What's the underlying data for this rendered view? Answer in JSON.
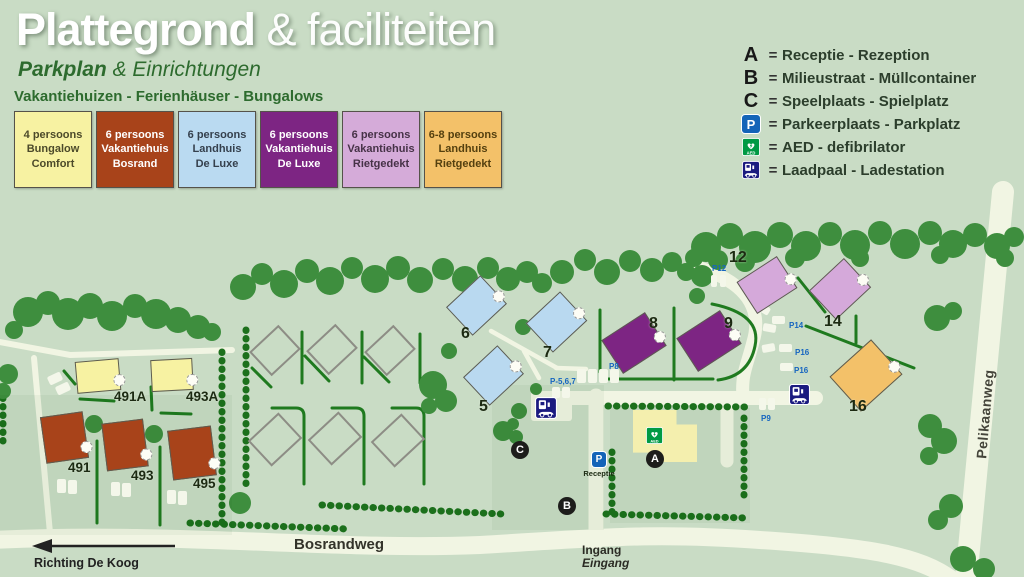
{
  "title": {
    "word1": "Plattegrond",
    "word2": "& faciliteiten",
    "sub1": "Parkplan",
    "sub2": "& Einrichtungen",
    "tagline": "Vakantiehuizen - Ferienhäuser - Bungalows"
  },
  "house_types": [
    {
      "id": "bungalow-comfort",
      "lines": [
        "4 persoons",
        "Bungalow",
        "Comfort"
      ],
      "bg": "#f7f2a2"
    },
    {
      "id": "vakantiehuis-bosrand",
      "lines": [
        "6 persoons",
        "Vakantiehuis",
        "Bosrand"
      ],
      "bg": "#a8431a"
    },
    {
      "id": "landhuis-de-luxe",
      "lines": [
        "6 persoons",
        "Landhuis",
        "De Luxe"
      ],
      "bg": "#badaf1"
    },
    {
      "id": "vakantiehuis-de-luxe",
      "lines": [
        "6 persoons",
        "Vakantiehuis",
        "De Luxe"
      ],
      "bg": "#7d2583"
    },
    {
      "id": "vakantiehuis-rietgedekt",
      "lines": [
        "6 persoons",
        "Vakantiehuis",
        "Rietgedekt"
      ],
      "bg": "#d5abd9"
    },
    {
      "id": "landhuis-rietgedekt",
      "lines": [
        "6-8 persoons",
        "Landhuis",
        "Rietgedekt"
      ],
      "bg": "#f3c169"
    }
  ],
  "facilities": [
    {
      "symbol": "A",
      "type": "letter",
      "label": "Receptie - Rezeption"
    },
    {
      "symbol": "B",
      "type": "letter",
      "label": "Milieustraat - Müllcontainer"
    },
    {
      "symbol": "C",
      "type": "letter",
      "label": "Speelplaats - Spielplatz"
    },
    {
      "symbol": "P",
      "type": "parking-icon",
      "label": "Parkeerplaats - Parkplatz"
    },
    {
      "symbol": "AED",
      "type": "aed-icon",
      "label": "AED - defibrilator"
    },
    {
      "symbol": "",
      "type": "charger-icon",
      "label": "Laadpaal - Ladestation"
    }
  ],
  "map": {
    "houses": [
      {
        "label": "491A"
      },
      {
        "label": "493A"
      },
      {
        "label": "491"
      },
      {
        "label": "493"
      },
      {
        "label": "495"
      },
      {
        "label": "5"
      },
      {
        "label": "6"
      },
      {
        "label": "7"
      },
      {
        "label": "8"
      },
      {
        "label": "9"
      },
      {
        "label": "12"
      },
      {
        "label": "14"
      },
      {
        "label": "16"
      }
    ],
    "parking_labels": [
      {
        "text": "P12"
      },
      {
        "text": "P14"
      },
      {
        "text": "P16"
      },
      {
        "text": "P16"
      },
      {
        "text": "P8"
      },
      {
        "text": "P9"
      },
      {
        "text": "P-5,6,7"
      }
    ],
    "markers": [
      {
        "letter": "A"
      },
      {
        "letter": "B"
      },
      {
        "letter": "C"
      }
    ],
    "receptie": "Receptie",
    "roads": {
      "bosrandweg": "Bosrandweg",
      "pelikaanweg": "Pelikaanweg",
      "ingang": "Ingang",
      "eingang": "Eingang",
      "richting": "Richting De Koog"
    }
  },
  "colors": {
    "background": "#c9dcc5",
    "road": "#f1f5e3",
    "tree": "#3e8e3e",
    "hedge": "#1c701c",
    "parking_blue": "#1464b8",
    "marker_black": "#1d1d1b",
    "aed_green": "#009a44",
    "charger_navy": "#1b1b80"
  }
}
